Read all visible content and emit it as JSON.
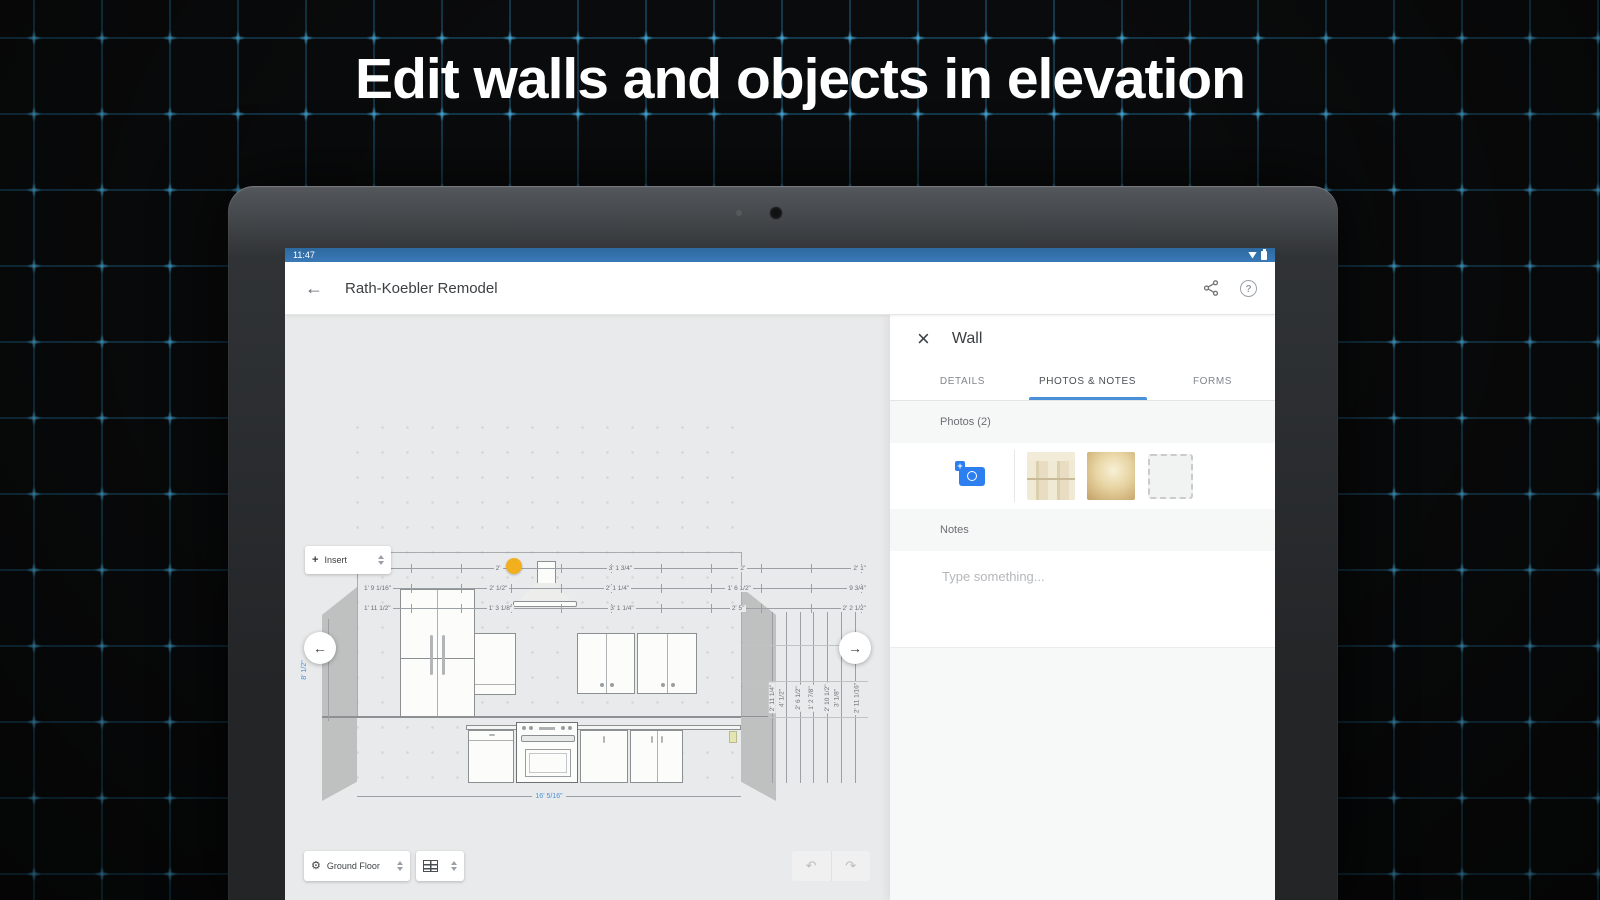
{
  "hero": {
    "title": "Edit walls and objects in elevation"
  },
  "status_bar": {
    "time": "11:47"
  },
  "app_bar": {
    "title": "Rath-Koebler Remodel"
  },
  "icons": {
    "back": "←",
    "close": "×",
    "help": "?",
    "prev": "←",
    "next": "→",
    "undo": "↶",
    "redo": "↷",
    "gear": "⚙",
    "insert_plus": "+"
  },
  "canvas": {
    "insert_control": {
      "label": "Insert"
    },
    "floor_control": {
      "label": "Ground Floor"
    },
    "dims": {
      "top_row_1": [
        "2' 0 3/4\"",
        "2'",
        "3' 1 3/4\"",
        "2'",
        "2' 1\""
      ],
      "top_row_2": [
        "1' 9 1/16\"",
        "2' 1/2\"",
        "2' 1 1/4\"",
        "1' 6 1/2\"",
        "9 3/4\""
      ],
      "top_row_3": [
        "1' 11 1/2\"",
        "1' 3 1/8\"",
        "3' 1 1/4\"",
        "2' 5\"",
        "2' 2 1/2\""
      ],
      "right_cols": [
        "2' 11 1/4\"",
        "4' 1/2\"",
        "2' 6 1/2\"",
        "1' 2 7/8\"",
        "2' 10 1/2\"",
        "3' 1/8\"",
        "2' 11 1/16\""
      ],
      "wall_height": "8' 1/2\"",
      "wall_width": "16' 5/16\""
    }
  },
  "panel": {
    "title": "Wall",
    "tabs": [
      {
        "label": "DETAILS"
      },
      {
        "label": "PHOTOS & NOTES"
      },
      {
        "label": "FORMS"
      }
    ],
    "photos_header": "Photos (2)",
    "notes_header": "Notes",
    "notes_placeholder": "Type something..."
  },
  "colors": {
    "status_bar_blue": "#3a7ab8",
    "accent_blue": "#4a90d9",
    "selection_yellow": "#f2b01e",
    "blueprint_line": "#206c94"
  }
}
